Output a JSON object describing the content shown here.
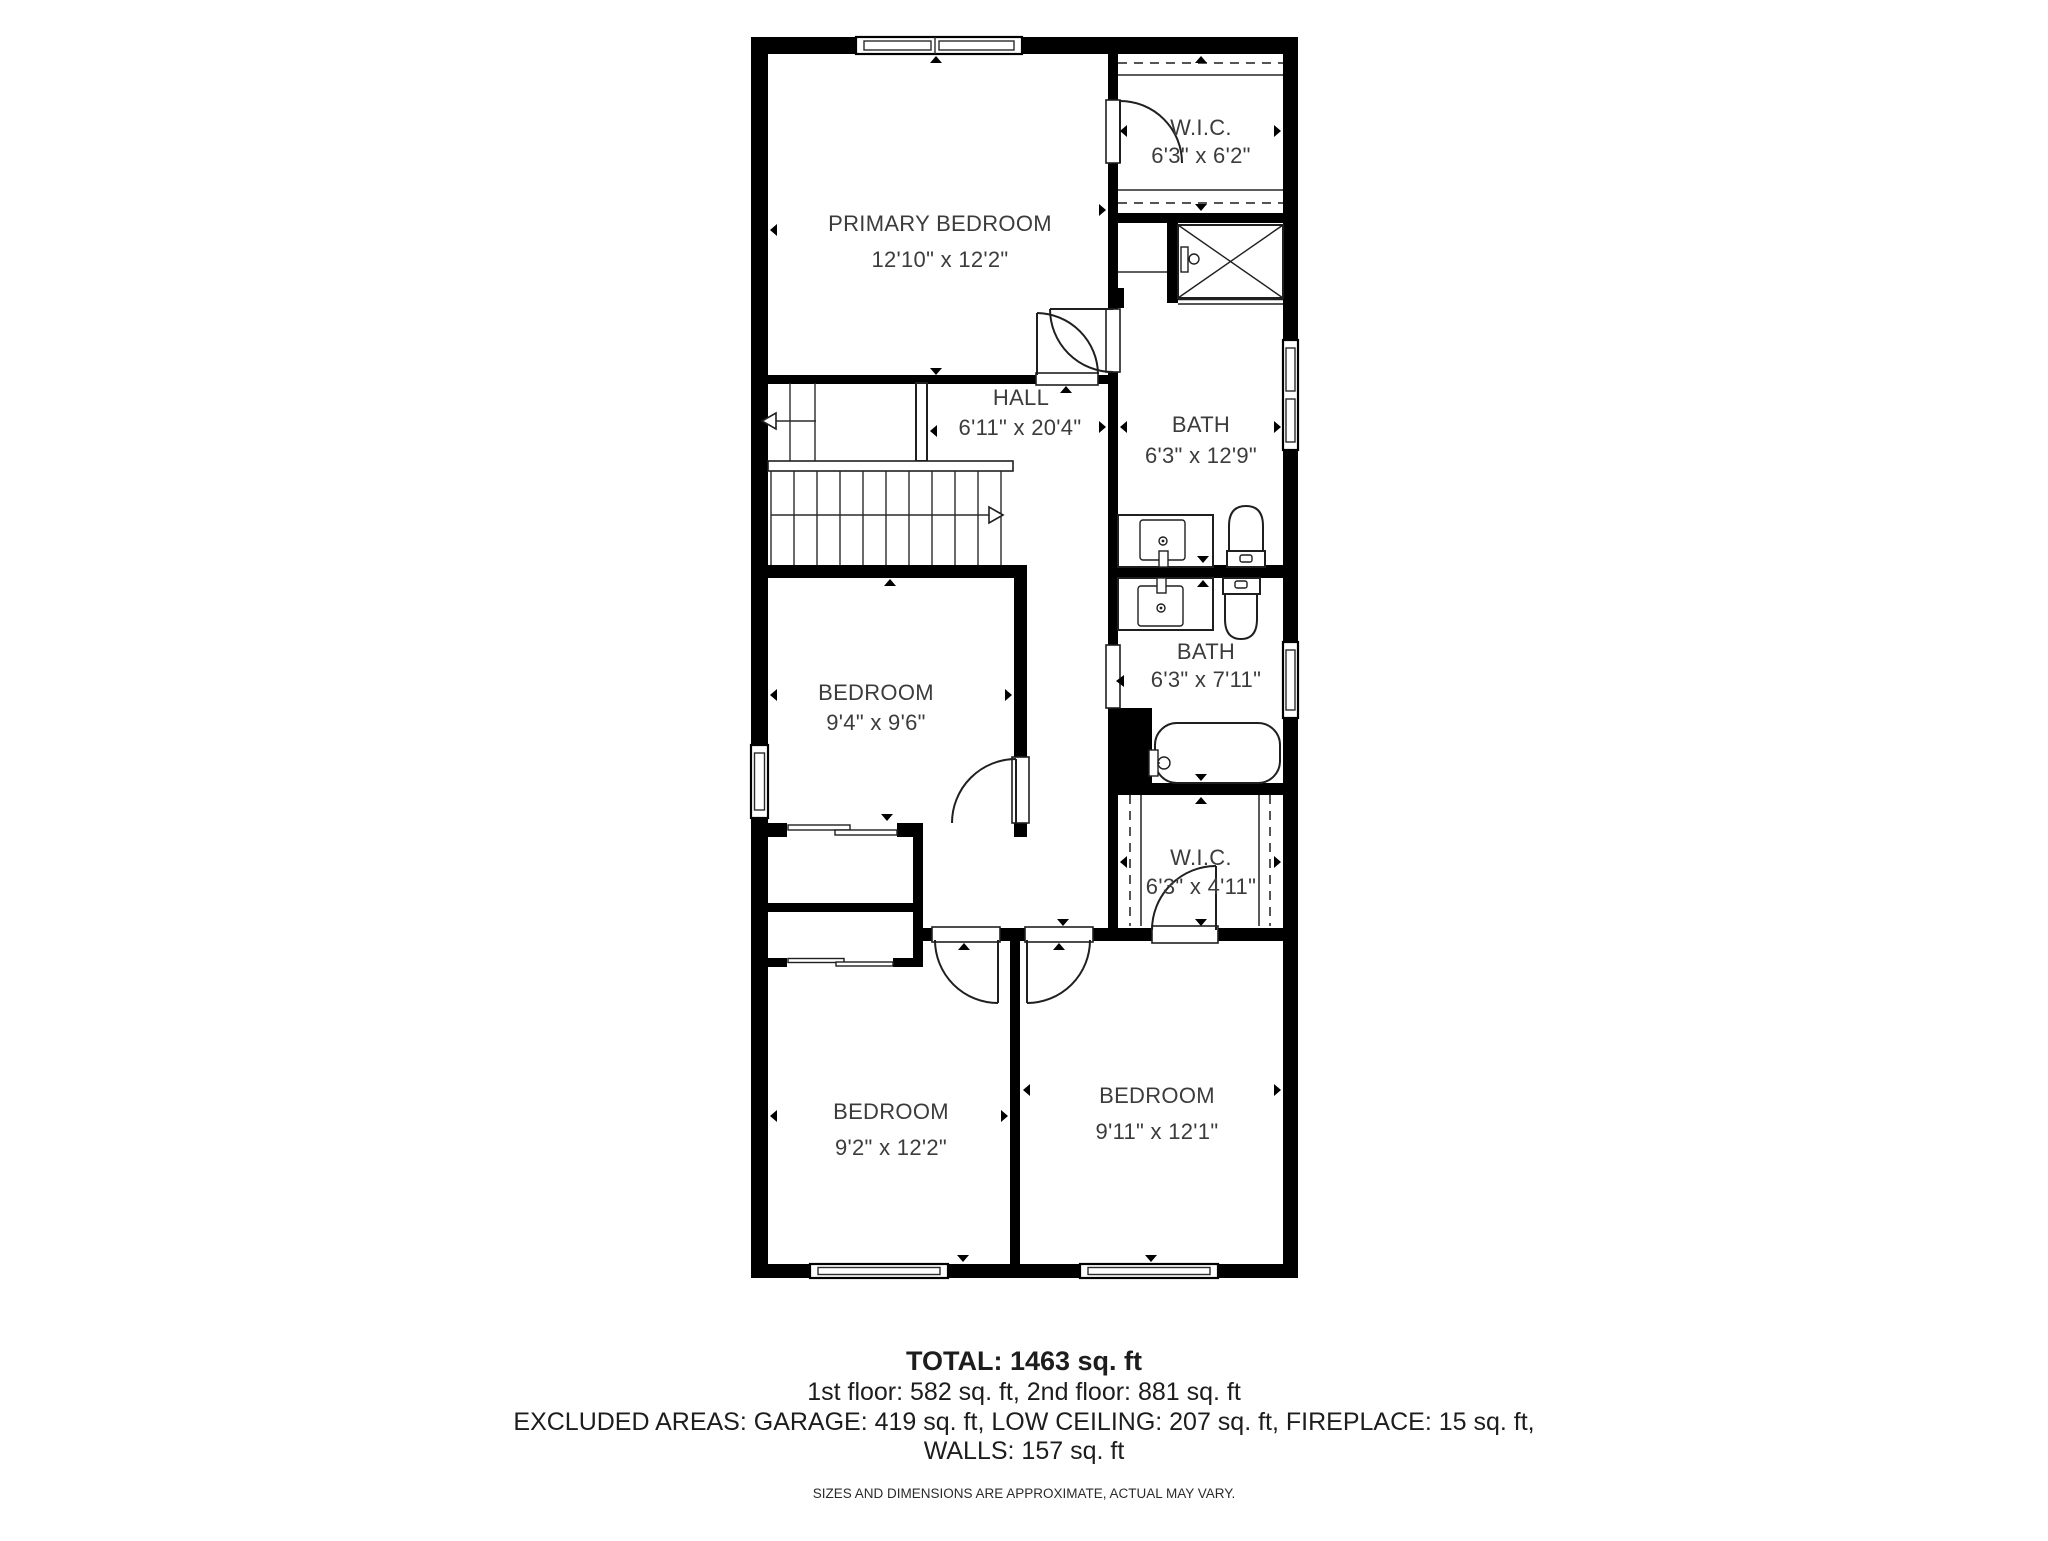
{
  "colors": {
    "background": "#ffffff",
    "wall": "#000000",
    "label": "#3c3c3c",
    "summary_text": "#1d1d1d"
  },
  "floor_plan": {
    "rooms": [
      {
        "name": "PRIMARY BEDROOM",
        "dims": "12'10\" x 12'2\""
      },
      {
        "name": "W.I.C.",
        "dims": "6'3\" x 6'2\""
      },
      {
        "name": "HALL",
        "dims": "6'11\" x 20'4\""
      },
      {
        "name": "BATH",
        "dims": "6'3\" x 12'9\""
      },
      {
        "name": "BEDROOM",
        "dims": "9'4\" x 9'6\""
      },
      {
        "name": "BATH",
        "dims": "6'3\" x 7'11\""
      },
      {
        "name": "W.I.C.",
        "dims": "6'3\" x 4'11\""
      },
      {
        "name": "BEDROOM",
        "dims": "9'2\" x 12'2\""
      },
      {
        "name": "BEDROOM",
        "dims": "9'11\" x 12'1\""
      }
    ]
  },
  "summary": {
    "total": "TOTAL: 1463 sq. ft",
    "floors": "1st floor: 582 sq. ft, 2nd floor: 881 sq. ft",
    "excluded_line1": "EXCLUDED AREAS: GARAGE: 419 sq. ft, LOW CEILING: 207 sq. ft, FIREPLACE: 15 sq. ft,",
    "excluded_line2": "WALLS: 157 sq. ft",
    "disclaimer": "SIZES AND DIMENSIONS ARE APPROXIMATE, ACTUAL MAY VARY."
  }
}
